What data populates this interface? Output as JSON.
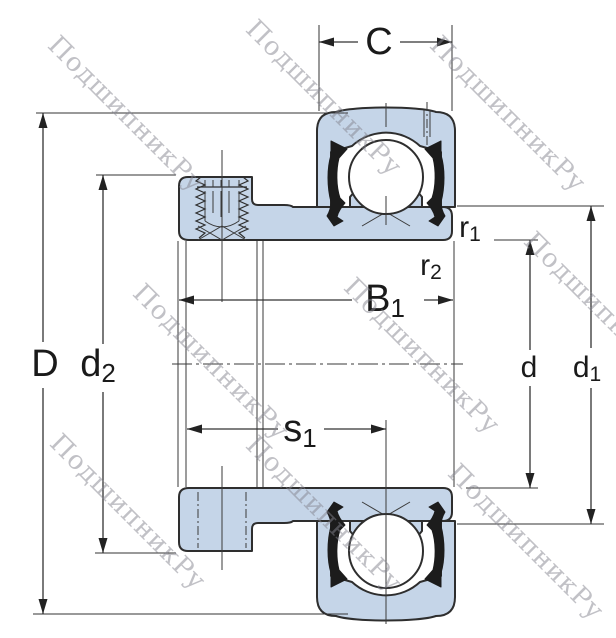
{
  "watermark": {
    "text": "ПодшипникРу"
  },
  "dimensions": {
    "C": {
      "main": "C",
      "sub": ""
    },
    "D": {
      "main": "D",
      "sub": ""
    },
    "d2": {
      "main": "d",
      "sub": "2"
    },
    "B1": {
      "main": "B",
      "sub": "1"
    },
    "s1": {
      "main": "s",
      "sub": "1"
    },
    "r1": {
      "main": "r",
      "sub": "1"
    },
    "r2": {
      "main": "r",
      "sub": "2"
    },
    "d": {
      "main": "d",
      "sub": ""
    },
    "d1": {
      "main": "d",
      "sub": "1"
    }
  },
  "colors": {
    "part_fill": "#c5d5e8",
    "outline": "#2e2e2e",
    "dimension_lines": "#333333",
    "watermark": "#84848f"
  },
  "drawing": {
    "type": "bearing-cross-section",
    "views": [
      "insert bearing with eccentric locking collar, full section"
    ],
    "labeled_dimensions": [
      "C",
      "D",
      "d2",
      "B1",
      "s1",
      "r1",
      "r2",
      "d",
      "d1"
    ]
  }
}
